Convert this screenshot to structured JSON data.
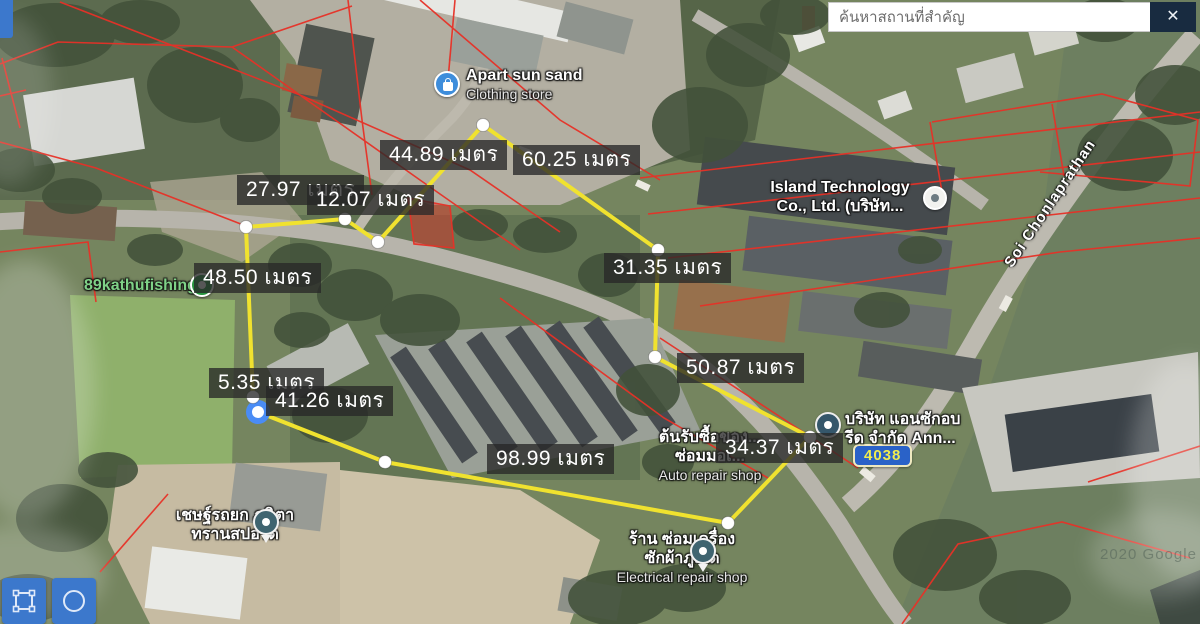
{
  "search": {
    "placeholder": "ค้นหาสถานที่สำคัญ",
    "close_glyph": "✕"
  },
  "colors": {
    "measure_line": "#f0e22f",
    "vertex_ring": "#4a8cf5",
    "parcel_line": "#e73127",
    "label_bg": "rgba(40,40,40,0.78)",
    "tool_button": "#3c78cc",
    "route_badge_bg": "#2a62c8",
    "route_badge_text": "#f0ec4f"
  },
  "measure": {
    "unit": "เมตร",
    "points": [
      [
        246,
        227
      ],
      [
        345,
        219
      ],
      [
        378,
        242
      ],
      [
        483,
        125
      ],
      [
        658,
        250
      ],
      [
        655,
        357
      ],
      [
        810,
        437
      ],
      [
        728,
        523
      ],
      [
        385,
        462
      ],
      [
        258,
        412
      ],
      [
        253,
        397
      ]
    ],
    "active_index": 9,
    "closed": true,
    "labels": [
      {
        "text": "44.89 เมตร",
        "x": 380,
        "y": 140
      },
      {
        "text": "60.25 เมตร",
        "x": 513,
        "y": 145
      },
      {
        "text": "27.97 เมตร",
        "x": 237,
        "y": 175
      },
      {
        "text": "12.07 เมตร",
        "x": 307,
        "y": 185
      },
      {
        "text": "48.50 เมตร",
        "x": 194,
        "y": 263
      },
      {
        "text": "31.35 เมตร",
        "x": 604,
        "y": 253
      },
      {
        "text": "50.87 เมตร",
        "x": 677,
        "y": 353
      },
      {
        "text": "5.35 เมตร",
        "x": 209,
        "y": 368
      },
      {
        "text": "41.26 เมตร",
        "x": 266,
        "y": 386
      },
      {
        "text": "98.99 เมตร",
        "x": 487,
        "y": 444
      },
      {
        "text": "34.37 เมตร",
        "x": 716,
        "y": 433
      }
    ]
  },
  "pois": {
    "apart": {
      "name": "Apart sun sand",
      "sub": "Clothing store"
    },
    "island": {
      "line1": "Island Technology",
      "line2": "Co., Ltd. (บริษัท..."
    },
    "kathu": {
      "name": "89kathufishing"
    },
    "ann": {
      "line1": "บริษัท แอนซักอบ",
      "line2": "รีด จำกัด Ann..."
    },
    "auto": {
      "line1": "ต้นรับซื้อของ...",
      "line2": "ซ่อมมอเ...",
      "sub": "Auto repair shop"
    },
    "electrical": {
      "line1": "ร้าน ซ่อมเครื่อง",
      "line2": "ซักผ้าภูเก็ต",
      "sub": "Electrical repair shop"
    },
    "towing": {
      "line1": "เชษฐ์รถยก ภนิตา",
      "line2": "ทรานสปอร์ต"
    }
  },
  "map": {
    "road_label": "Soi Chonlaprathan",
    "route_number": "4038",
    "attribution": "2020 Google"
  },
  "tools": {
    "polygon_tool": "draw-polygon",
    "circle_tool": "draw-circle"
  }
}
